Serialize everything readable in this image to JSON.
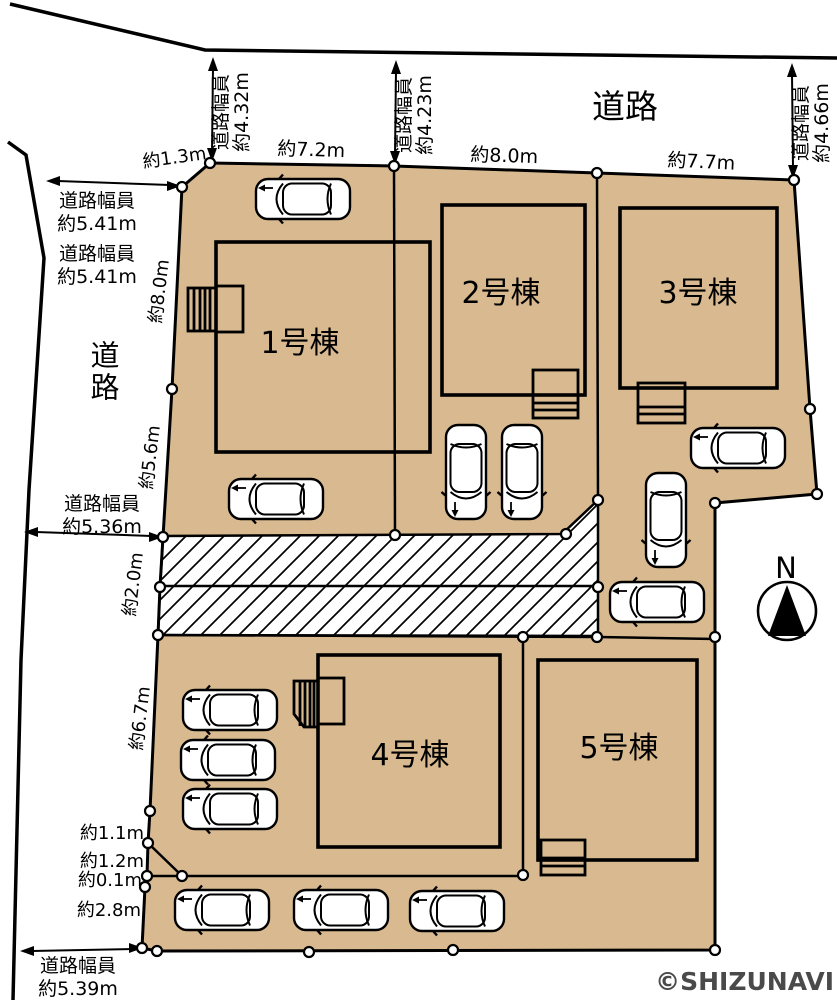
{
  "plan": {
    "roads": {
      "top": "道路",
      "left": "道路"
    },
    "width_prefix": "道路幅員",
    "road_widths": {
      "top_left": "約4.32m",
      "top_mid": "約4.23m",
      "top_right": "約4.66m",
      "left_upper_a": "約5.41m",
      "left_upper_b": "約5.41m",
      "left_mid": "約5.36m",
      "left_bottom": "約5.39m"
    },
    "boundary_dims": {
      "corner": "約1.3m",
      "top_lot1": "約7.2m",
      "top_lot2": "約8.0m",
      "top_lot3": "約7.7m",
      "left_1": "約8.0m",
      "left_2": "約5.6m",
      "left_3": "約2.0m",
      "left_4": "約6.7m",
      "left_5": "約1.1m",
      "left_6": "約1.2m",
      "left_7": "約0.1m",
      "left_8": "約2.8m"
    },
    "buildings": {
      "b1": "1号棟",
      "b2": "2号棟",
      "b3": "3号棟",
      "b4": "4号棟",
      "b5": "5号棟"
    },
    "compass": "N",
    "watermark": "©SHIZUNAVI",
    "colors": {
      "lot_fill": "#d9ba90",
      "line": "#000000",
      "hatch_bg": "#ffffff",
      "watermark": "#4a4a4a"
    }
  }
}
